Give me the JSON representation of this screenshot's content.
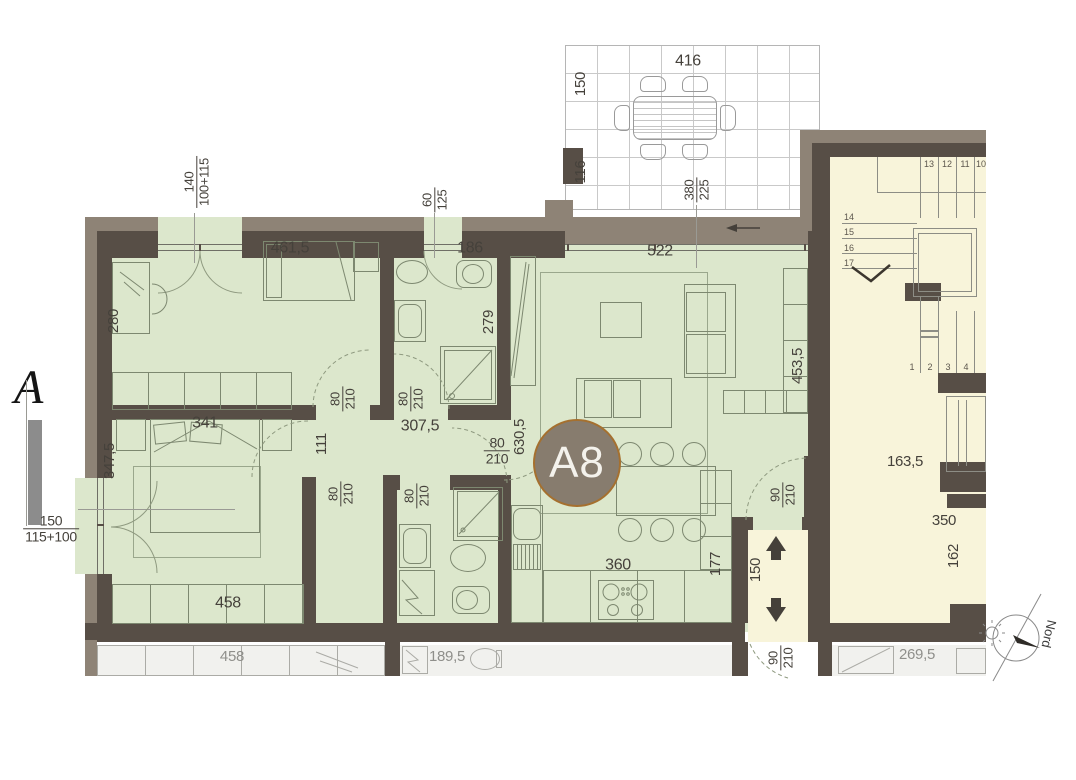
{
  "colors": {
    "apartment_fill": "#dce7cc",
    "common_fill": "#f8f4da",
    "wall": "#574e46",
    "wall_outer": "#8e8376",
    "badge_fill": "#877c6e",
    "badge_ring": "#a5702f"
  },
  "badge": {
    "label": "A8"
  },
  "section": {
    "marker": "A"
  },
  "compass": {
    "label": "Nord"
  },
  "terrace": {
    "width": "416",
    "side_top": "150",
    "side_bottom": "116",
    "door_top": "380",
    "door_bottom": "225"
  },
  "windows": {
    "bedroom": {
      "w": "140",
      "h": "100+115"
    },
    "bath": {
      "w": "60",
      "h": "125"
    },
    "master": {
      "w": "150",
      "h": "115+100"
    }
  },
  "rooms": {
    "living_glazing": "522",
    "living_right": "453,5",
    "living_left": "630,5",
    "bedroom_top_width": "461,5",
    "bedroom_top_depth": "280",
    "bath_top_width": "186",
    "bath_top_depth": "279",
    "hall_width": "307,5",
    "hall_depth": "111",
    "master_bed": "341",
    "master_depth": "347,5",
    "master_wardrobe": "458",
    "kitchen_run": "360",
    "kitchen_counter": "177"
  },
  "doors": {
    "interior_w": "80",
    "interior_h": "210",
    "entry_w": "90",
    "entry_h": "210"
  },
  "corridor": {
    "width": "150"
  },
  "stairwell": {
    "hall_width": "163,5",
    "lift_width": "350",
    "lift_depth": "162",
    "steps_top": [
      "13",
      "12",
      "11",
      "10"
    ],
    "steps_left": [
      "14",
      "15",
      "16",
      "17"
    ],
    "steps_bottom": [
      "1",
      "2",
      "3",
      "4"
    ]
  },
  "neighbor": {
    "wardrobe": "458",
    "bath": "189,5",
    "right_room": "269,5"
  }
}
